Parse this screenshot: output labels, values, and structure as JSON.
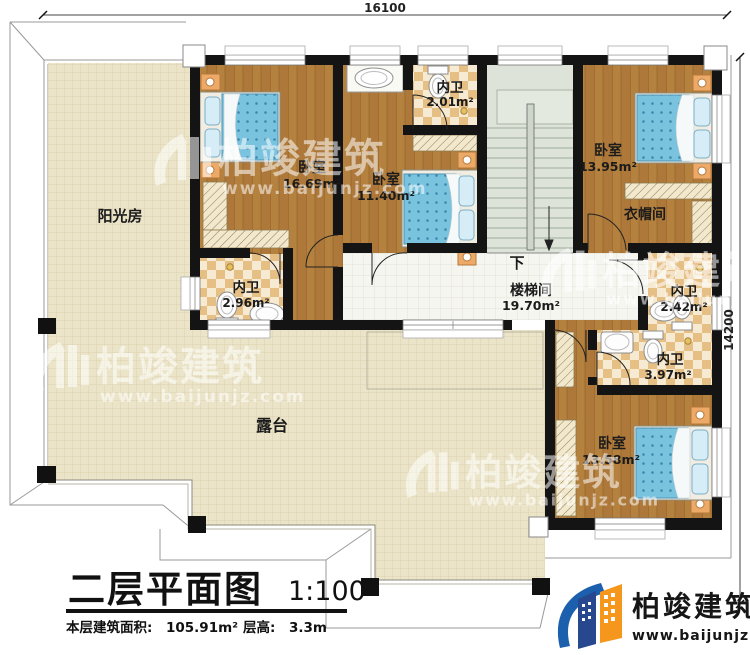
{
  "dims": {
    "top": "16100",
    "right": "14200"
  },
  "rooms": [
    {
      "id": "sunroom",
      "name": "阳光房",
      "area": ""
    },
    {
      "id": "bedroom1",
      "name": "卧室",
      "area": "16.69m²"
    },
    {
      "id": "bath1",
      "name": "内卫",
      "area": "2.96m²"
    },
    {
      "id": "bedroom2",
      "name": "卧室",
      "area": "11.40m²"
    },
    {
      "id": "bath2",
      "name": "内卫",
      "area": "2.01m²"
    },
    {
      "id": "stairwell",
      "name": "楼梯间",
      "area": "19.70m²"
    },
    {
      "id": "bedroom3",
      "name": "卧室",
      "area": "13.95m²"
    },
    {
      "id": "cloakroom",
      "name": "衣帽间",
      "area": ""
    },
    {
      "id": "bath3",
      "name": "内卫",
      "area": "2.42m²"
    },
    {
      "id": "bath4",
      "name": "内卫",
      "area": "3.97m²"
    },
    {
      "id": "bedroom4",
      "name": "卧室",
      "area": "13.58m²"
    },
    {
      "id": "terrace",
      "name": "露台",
      "area": ""
    }
  ],
  "stairs": {
    "direction_label": "下"
  },
  "titleblock": {
    "title": "二层平面图",
    "scale": "1:100",
    "area_label": "本层建筑面积:",
    "area_value": "105.91m²",
    "height_label": "层高:",
    "height_value": "3.3m"
  },
  "brand": {
    "name": "柏竣建筑",
    "website": "www.baijunjz.com"
  },
  "watermark": {
    "name": "柏竣建筑",
    "website": "www.baijunjz.com"
  },
  "colors": {
    "wall": "#141414",
    "wood": "#b07c3c",
    "bath_tile": "#e6bf85",
    "terrace": "#ece4c9",
    "stair": "#dde3d8",
    "bed_blue": "#79c3df",
    "brand_blue": "#1c5fad",
    "brand_dark_blue": "#27488f",
    "brand_orange": "#f5971d"
  }
}
